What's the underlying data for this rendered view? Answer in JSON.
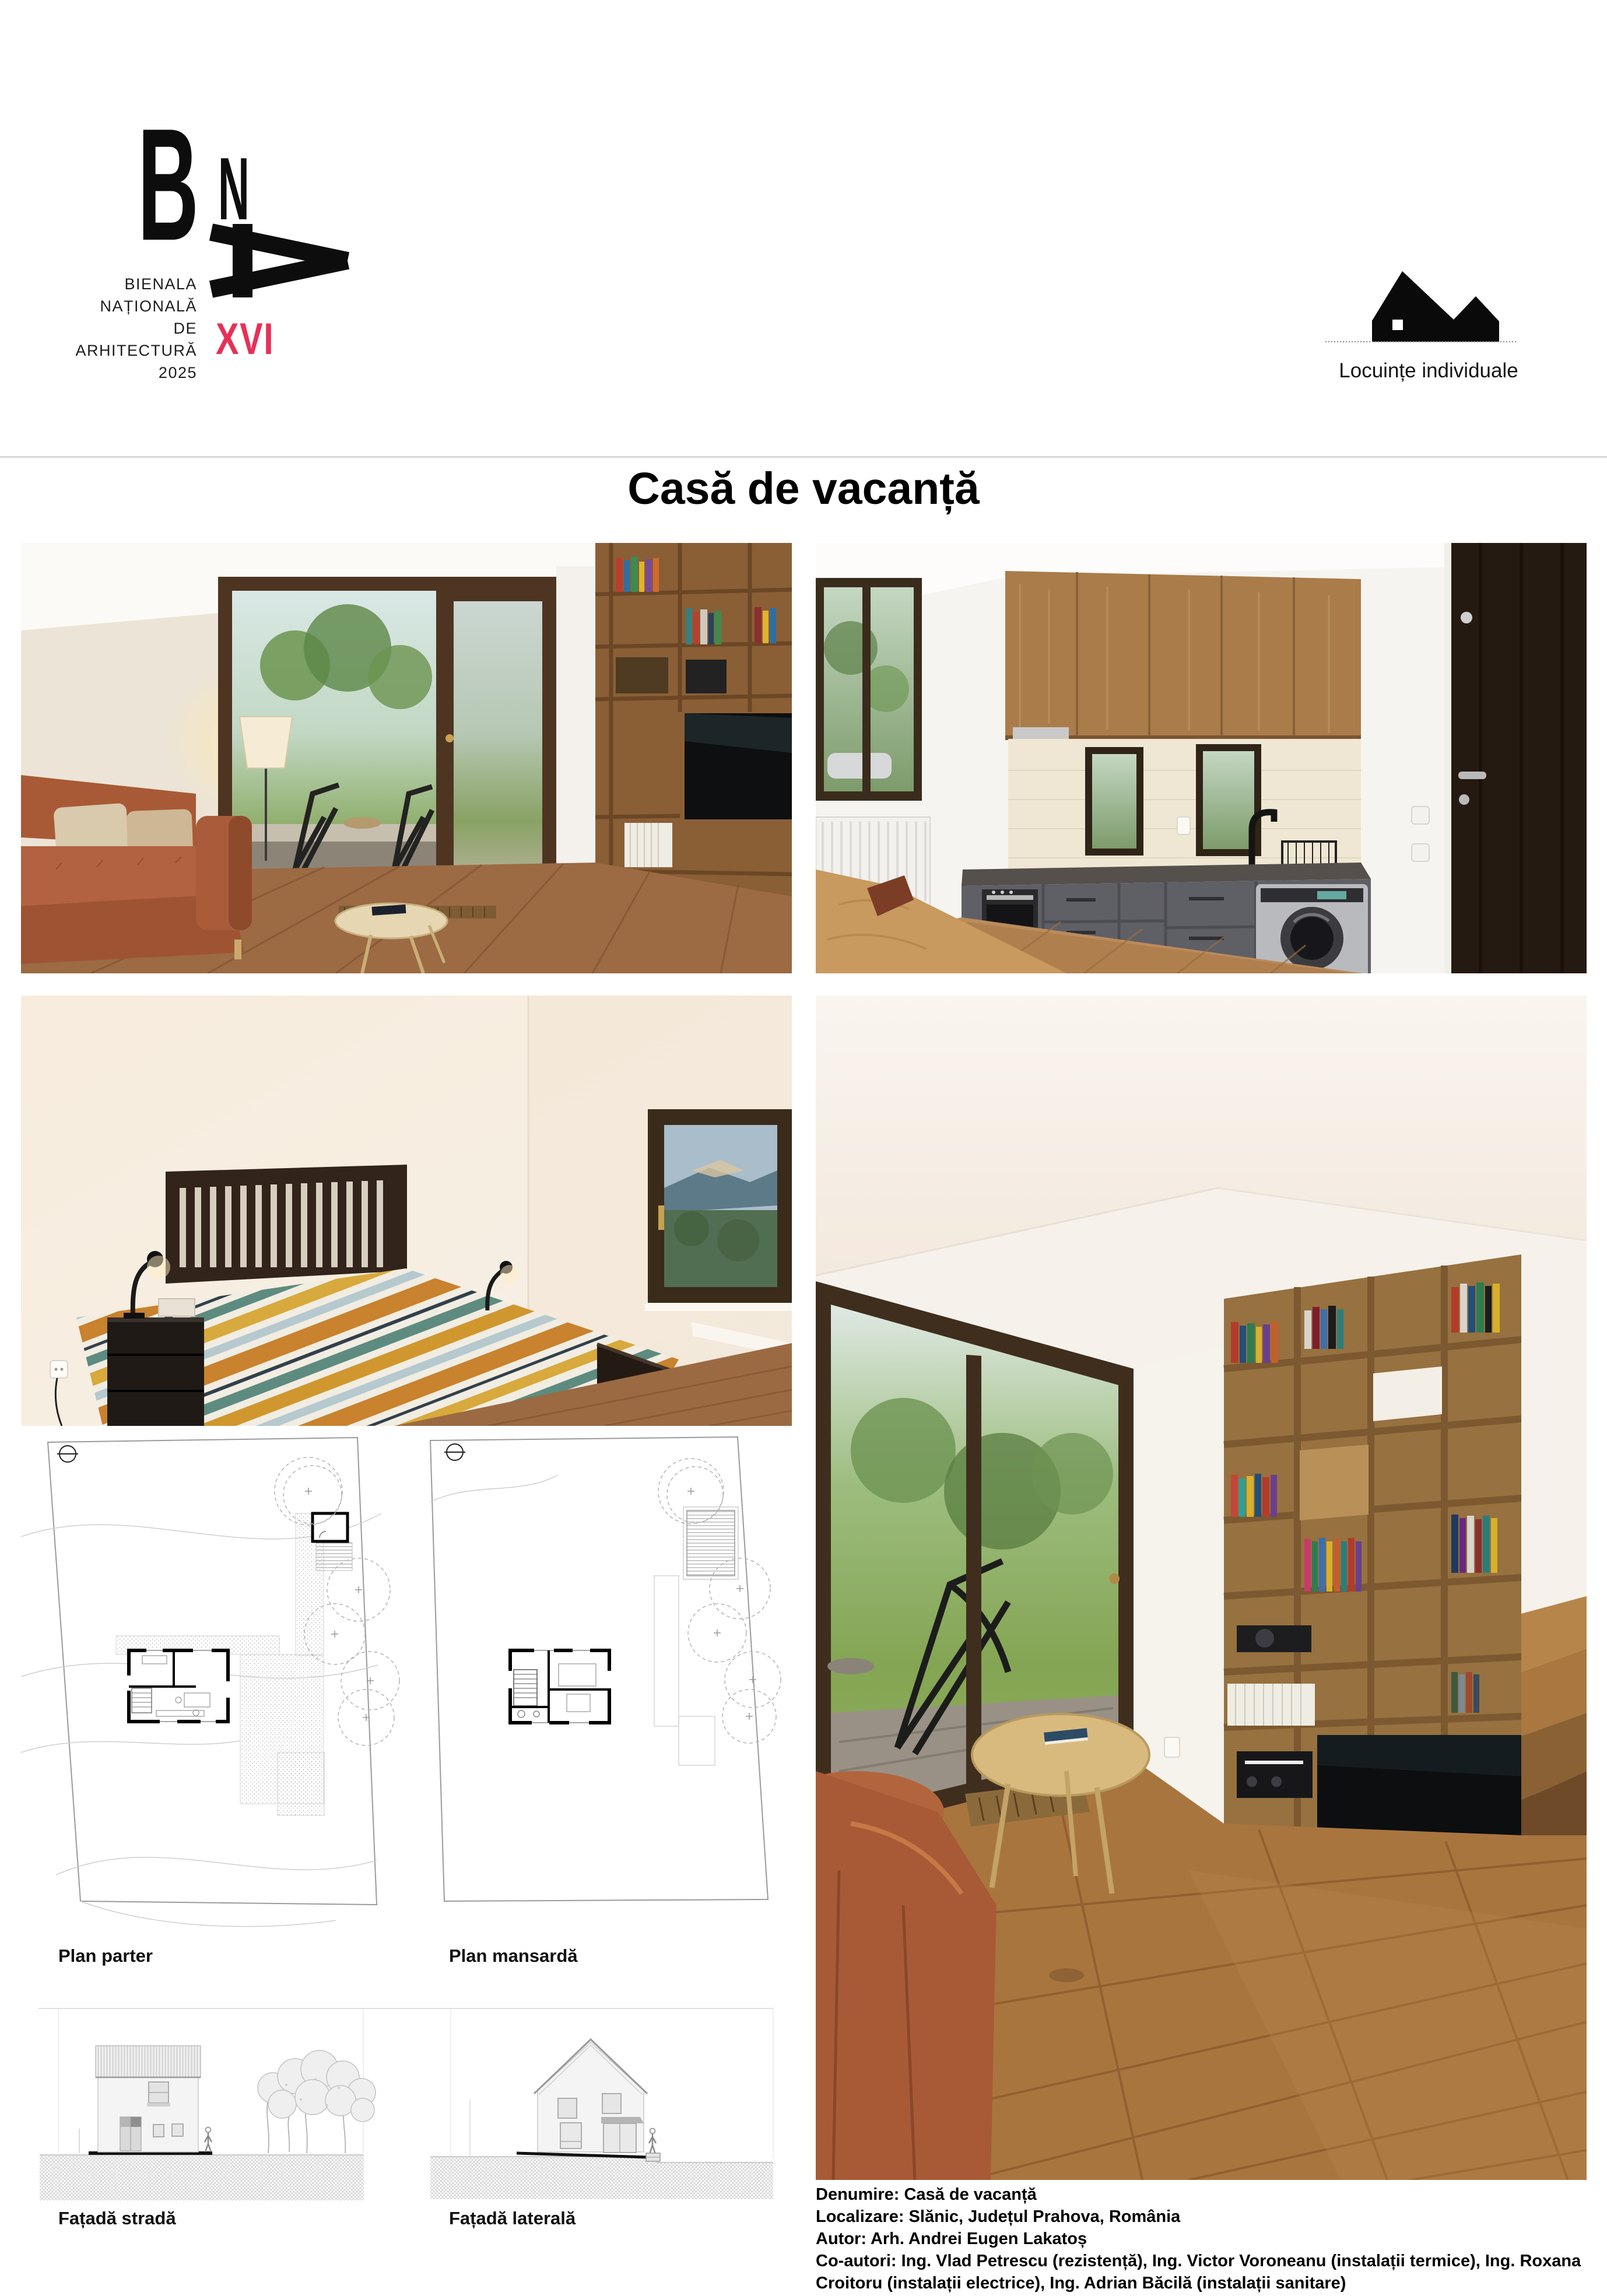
{
  "header": {
    "logo": {
      "letter_b": "B",
      "letter_n": "N",
      "caption_lines": [
        "BIENALA",
        "NAȚIONALĂ",
        "DE",
        "ARHITECTURĂ",
        "2025"
      ],
      "edition": "XVI"
    },
    "category": {
      "label": "Locuințe individuale"
    }
  },
  "title": "Casă de vacanță",
  "section_labels": {
    "plan_left": "Plan parter",
    "plan_right": "Plan mansardă",
    "facade_left": "Fațadă stradă",
    "facade_right": "Fațadă laterală"
  },
  "details": {
    "lines": [
      "Denumire: Casă de vacanță",
      "Localizare: Slănic, Județul Prahova, România",
      "Autor: Arh. Andrei Eugen Lakatoș",
      "Co-autori: Ing. Vlad Petrescu (rezistență), Ing. Victor Voroneanu (instalații termice), Ing. Roxana Croitoru (instalații electrice), Ing. Adrian Băcilă (instalații sanitare)"
    ]
  },
  "colors": {
    "accent": "#e73058",
    "ink": "#1d1d1b",
    "separator": "#d8d8d8"
  }
}
